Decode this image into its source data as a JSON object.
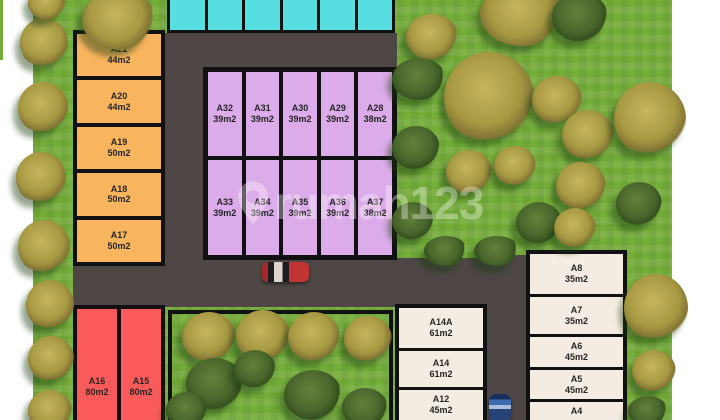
{
  "watermark": {
    "brand": "rumah123"
  },
  "colors": {
    "teal": "#56dee0",
    "orange": "#f8b55e",
    "purple": "#dcabe9",
    "red": "#fa5a5a",
    "cream": "#f4ece2",
    "road": "#4e4645",
    "green": "#75ad3a",
    "line": "#111111"
  },
  "plots": {
    "teal": {
      "note": "6 unlabeled units cut off at top edge",
      "units_visible": 6
    },
    "orange": {
      "units": [
        {
          "id": "A21",
          "area": "44m2"
        },
        {
          "id": "A20",
          "area": "44m2"
        },
        {
          "id": "A19",
          "area": "50m2"
        },
        {
          "id": "A18",
          "area": "50m2"
        },
        {
          "id": "A17",
          "area": "50m2"
        }
      ]
    },
    "purple": {
      "row1": [
        {
          "id": "A32",
          "area": "39m2"
        },
        {
          "id": "A31",
          "area": "39m2"
        },
        {
          "id": "A30",
          "area": "39m2"
        },
        {
          "id": "A29",
          "area": "39m2"
        },
        {
          "id": "A28",
          "area": "38m2"
        }
      ],
      "row2": [
        {
          "id": "A33",
          "area": "39m2"
        },
        {
          "id": "A34",
          "area": "39m2"
        },
        {
          "id": "A35",
          "area": "39m2"
        },
        {
          "id": "A36",
          "area": "39m2"
        },
        {
          "id": "A37",
          "area": "38m2"
        }
      ]
    },
    "red": {
      "units": [
        {
          "id": "A16",
          "area": "80m2"
        },
        {
          "id": "A15",
          "area": "80m2"
        }
      ]
    },
    "bottom_center": {
      "units": [
        {
          "id": "A14A",
          "area": "61m2"
        },
        {
          "id": "A14",
          "area": "61m2"
        },
        {
          "id": "A12",
          "area": "45m2"
        }
      ]
    },
    "right": {
      "units": [
        {
          "id": "A8",
          "area": "35m2"
        },
        {
          "id": "A7",
          "area": "35m2"
        },
        {
          "id": "A6",
          "area": "45m2"
        },
        {
          "id": "A5",
          "area": "45m2"
        },
        {
          "id": "A4",
          "area": ""
        }
      ]
    }
  }
}
